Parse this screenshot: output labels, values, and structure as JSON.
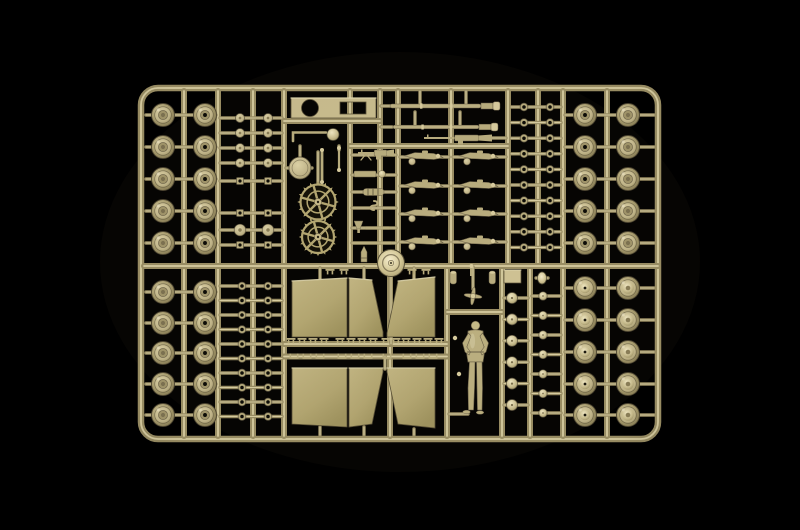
{
  "meta": {
    "title": "Tan model kit sprue on black background",
    "description": "Photograph of a tan injection-molded model kit sprue holding tank road wheels, drive sprockets, gun barrels, machine guns, suspension bogies, fender panels, hub caps, small clamps and a standing crew figure, lit against a black background."
  },
  "palette": {
    "background": "#000000",
    "runner": "#9a8e64",
    "runner_highlight": "#d8cda1",
    "runner_shadow": "#4f4732",
    "part_mid": "#b9ad7e",
    "part_light": "#d8cc9e",
    "part_lighter": "#efe6c2",
    "part_dark": "#6b6148",
    "part_deep": "#0d0c07",
    "panel_edge": "#5a5138",
    "plate": "#c9bc8e"
  },
  "scene": {
    "width": 800,
    "height": 530,
    "frame": {
      "x": 141,
      "y": 88,
      "w": 517,
      "h": 351,
      "rx": 17
    },
    "runners": {
      "vertical_full": [
        184,
        218,
        253,
        284,
        563,
        607
      ],
      "vertical_top": [
        350,
        380,
        398,
        451,
        508,
        538
      ],
      "vertical_bottom": [
        390,
        447,
        502,
        530
      ],
      "horizontal": [
        [
          144,
          658,
          266
        ],
        [
          284,
          380,
          121
        ],
        [
          350,
          508,
          146
        ],
        [
          447,
          502,
          312
        ],
        [
          284,
          447,
          344
        ],
        [
          284,
          447,
          356.5
        ]
      ]
    },
    "gates": [
      [
        420,
        91,
        420,
        104
      ],
      [
        466,
        91,
        466,
        104
      ],
      [
        415,
        112,
        415,
        125
      ],
      [
        460,
        112,
        460,
        125
      ],
      [
        381,
        106,
        390,
        106
      ],
      [
        381,
        127,
        392,
        127
      ],
      [
        482,
        138,
        506,
        138
      ],
      [
        286,
        168,
        312,
        168
      ],
      [
        318,
        152,
        318,
        253
      ],
      [
        391,
        268,
        391,
        344
      ],
      [
        385,
        356,
        385,
        369
      ],
      [
        320,
        268,
        320,
        279
      ],
      [
        364,
        268,
        364,
        279
      ],
      [
        414,
        268,
        414,
        279
      ],
      [
        320,
        427,
        320,
        435
      ],
      [
        364,
        427,
        364,
        435
      ],
      [
        414,
        429,
        414,
        435
      ],
      [
        449,
        414,
        468,
        414
      ],
      [
        473,
        267,
        473,
        289
      ],
      [
        536,
        278,
        548,
        278
      ],
      [
        339,
        146,
        339,
        150
      ],
      [
        300,
        156,
        300,
        146
      ]
    ],
    "misc_gate_ys": [
      155,
      175,
      192,
      208,
      228,
      243
    ],
    "misc_gate_band": [
      352,
      396
    ],
    "wheel_grids": [
      {
        "name": "wheels-top-left",
        "cols": [
          163,
          205
        ],
        "rows": [
          115,
          147,
          179,
          211,
          243
        ],
        "r": 11.5,
        "band": [
          146,
          216
        ],
        "col_styles": [
          "ring",
          "open"
        ]
      },
      {
        "name": "wheels-bottom-left",
        "cols": [
          163,
          205
        ],
        "rows": [
          292,
          323,
          353,
          384,
          415
        ],
        "r": 11.5,
        "band": [
          146,
          216
        ],
        "col_styles": [
          "ring",
          "open"
        ]
      },
      {
        "name": "wheels-top-right",
        "cols": [
          585,
          628
        ],
        "rows": [
          115,
          147,
          179,
          211,
          243
        ],
        "r": 11.5,
        "band": [
          565,
          654
        ],
        "col_styles": [
          "open",
          "ring"
        ]
      },
      {
        "name": "wheels-bottom-right",
        "cols": [
          585,
          628
        ],
        "rows": [
          288,
          320,
          352,
          384,
          415
        ],
        "r": 11.5,
        "band": [
          565,
          654
        ],
        "col_styles": [
          "dished",
          "dished2"
        ]
      }
    ],
    "ring_columns": [
      {
        "name": "track-rings-top-right",
        "cols": [
          524,
          550
        ],
        "y0": 107,
        "dy": 15.6,
        "n": 10,
        "r": 3.9,
        "band": [
          511,
          561
        ],
        "kind": "ring"
      },
      {
        "name": "track-rings-bottom-left",
        "cols": [
          242,
          268
        ],
        "y0": 286,
        "dy": 14.5,
        "n": 10,
        "r": 3.9,
        "band": [
          220,
          282
        ],
        "kind": "ring"
      },
      {
        "name": "hub-caps-bottom-right",
        "cols": [
          512
        ],
        "y0": 298,
        "dy": 21.4,
        "n": 6,
        "r": 5.5,
        "band": [
          504,
          528
        ],
        "kind": "dome"
      },
      {
        "name": "small-caps-bottom-right",
        "cols": [
          543
        ],
        "y0": 296,
        "dy": 19.5,
        "n": 7,
        "r": 4.2,
        "band": [
          532,
          561
        ],
        "kind": "dome"
      }
    ],
    "small_part_columns": {
      "cols": [
        240,
        268
      ],
      "band": [
        220,
        282
      ],
      "items": [
        {
          "y": 118,
          "kind": "disc",
          "r": 4.5
        },
        {
          "y": 133,
          "kind": "disc",
          "r": 4.5
        },
        {
          "y": 148,
          "kind": "disc",
          "r": 4.5
        },
        {
          "y": 163,
          "kind": "disc",
          "r": 4.5
        },
        {
          "y": 181,
          "kind": "square",
          "s": 7
        },
        {
          "y": 213,
          "kind": "square",
          "s": 7
        },
        {
          "y": 230,
          "kind": "disc",
          "r": 5.8
        },
        {
          "y": 245,
          "kind": "square",
          "s": 7
        }
      ]
    },
    "panels": [
      {
        "name": "fender-panel-a",
        "pts": [
          [
            292,
            281
          ],
          [
            347,
            278
          ],
          [
            347,
            337
          ],
          [
            292,
            337
          ]
        ]
      },
      {
        "name": "fender-panel-b",
        "pts": [
          [
            349,
            278
          ],
          [
            372,
            280
          ],
          [
            383,
            332
          ],
          [
            383,
            337
          ],
          [
            349,
            337
          ]
        ]
      },
      {
        "name": "fender-panel-c",
        "pts": [
          [
            398,
            281
          ],
          [
            435,
            277
          ],
          [
            435,
            337
          ],
          [
            387,
            337
          ],
          [
            387,
            333
          ]
        ]
      },
      {
        "name": "fender-panel-d",
        "pts": [
          [
            292,
            368
          ],
          [
            347,
            368
          ],
          [
            347,
            427
          ],
          [
            292,
            424
          ]
        ]
      },
      {
        "name": "fender-panel-e",
        "pts": [
          [
            349,
            368
          ],
          [
            383,
            368
          ],
          [
            383,
            372
          ],
          [
            372,
            424
          ],
          [
            349,
            427
          ]
        ]
      },
      {
        "name": "fender-panel-f",
        "pts": [
          [
            387,
            368
          ],
          [
            435,
            368
          ],
          [
            435,
            428
          ],
          [
            398,
            424
          ],
          [
            387,
            372
          ]
        ]
      }
    ],
    "clamps": {
      "t_row": {
        "y": 342,
        "xs": [
          291,
          302,
          313,
          324,
          340,
          351,
          362,
          373,
          386,
          396,
          406,
          417,
          428,
          439
        ]
      },
      "u_row": {
        "y": 355,
        "xs": [
          294,
          307,
          320,
          342,
          355,
          368,
          387,
          407,
          420,
          433
        ]
      },
      "top_pairs": {
        "y": 273,
        "xs": [
          330,
          344,
          412,
          426
        ]
      }
    },
    "bogies": {
      "cols": [
        424,
        479
      ],
      "rows": [
        157,
        186,
        214,
        242
      ],
      "bands": [
        [
          400,
          449
        ],
        [
          453,
          506
        ]
      ]
    },
    "sprockets": [
      {
        "cx": 318,
        "cy": 202,
        "r": 17.5
      },
      {
        "cx": 318,
        "cy": 237,
        "r": 16
      }
    ],
    "idler": {
      "cx": 391,
      "cy": 263,
      "r": 13.5
    },
    "hatch": {
      "cx": 300,
      "cy": 168,
      "r": 11
    },
    "plate": {
      "x": 291,
      "y": 98,
      "w": 85,
      "h": 20,
      "hole": {
        "cx": 310,
        "cy": 108,
        "r": 8.5
      },
      "notch": {
        "x": 340,
        "y": 102,
        "w": 26,
        "h": 12
      }
    },
    "barrels": [
      {
        "x1": 390,
        "x2": 481,
        "y": 106,
        "w": 4
      },
      {
        "x1": 393,
        "x2": 479,
        "y": 127,
        "w": 3.6
      }
    ],
    "machine_guns": [
      {
        "x": 424,
        "y": 138,
        "len": 68,
        "name": "hull-machine-gun",
        "bipod": false
      },
      {
        "x": 358,
        "y": 153,
        "len": 36,
        "name": "mg34-machine-gun",
        "bipod": true
      }
    ],
    "figure": {
      "cx": 475.5,
      "head_y": 325.5,
      "head_r": 4.3
    },
    "propeller": {
      "cx": 473,
      "cy": 296,
      "r": 9
    },
    "misc": [
      {
        "t": "lrod",
        "d": "M293,141 L293,132.5 L326,132.5"
      },
      {
        "t": "knob",
        "cx": 333,
        "cy": 134.5,
        "r": 6
      },
      {
        "t": "vrod",
        "x": 322,
        "y1": 150,
        "y2": 182,
        "w": 2.8
      },
      {
        "t": "vrod",
        "x": 339,
        "y1": 148,
        "y2": 170,
        "w": 2.2
      },
      {
        "t": "bracket",
        "x": 354,
        "y": 171
      },
      {
        "t": "muffler",
        "x": 363,
        "y": 188.5
      },
      {
        "t": "shook",
        "x": 374,
        "y": 201
      },
      {
        "t": "funnel",
        "x": 354,
        "y": 221
      },
      {
        "t": "hrod",
        "x1": 365,
        "x2": 390,
        "y": 228
      },
      {
        "t": "hrod",
        "x1": 352,
        "x2": 392,
        "y": 243
      },
      {
        "t": "shell",
        "x": 364,
        "y": 246
      },
      {
        "t": "cyl",
        "x": 450,
        "y": 271
      },
      {
        "t": "pin",
        "x": 470,
        "y": 266
      },
      {
        "t": "cyl",
        "x": 489,
        "y": 271
      },
      {
        "t": "sqpart",
        "x": 504,
        "y": 270,
        "w": 17,
        "h": 13
      },
      {
        "t": "egg",
        "cx": 542,
        "cy": 278
      },
      {
        "t": "smallbit",
        "cx": 455,
        "cy": 338
      },
      {
        "t": "smallbit",
        "cx": 459,
        "cy": 374
      }
    ]
  }
}
